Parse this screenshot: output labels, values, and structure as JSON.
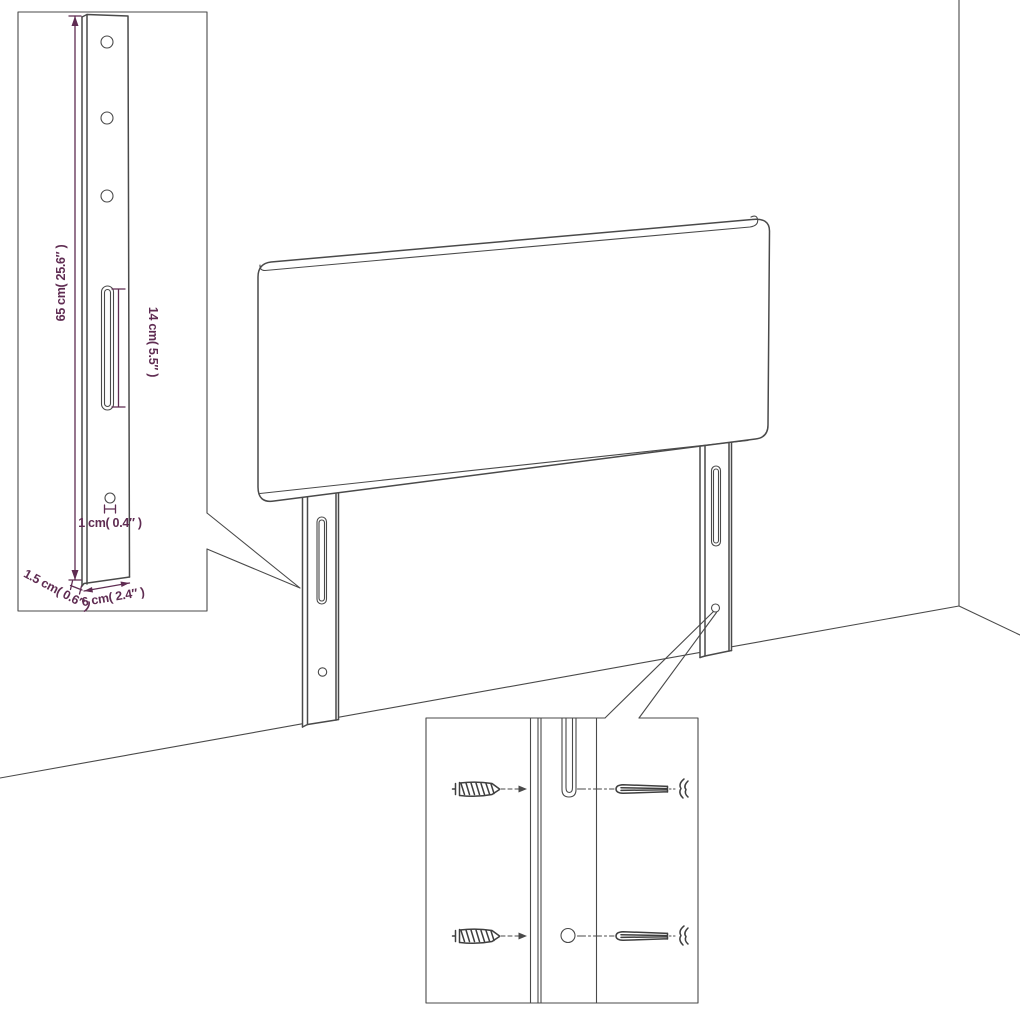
{
  "page": {
    "background": "#ffffff"
  },
  "colors": {
    "line": "#4a4a4a",
    "dimension_text": "#5f2c52"
  },
  "labels": {
    "leg_height": "65 cm( 25.6″ )",
    "slot_length": "14 cm( 5.5″ )",
    "hole_diameter": "1 cm( 0.4″ )",
    "leg_thickness": "1.5 cm( 0.6″ )",
    "leg_width": "6 cm( 2.4″ )"
  }
}
